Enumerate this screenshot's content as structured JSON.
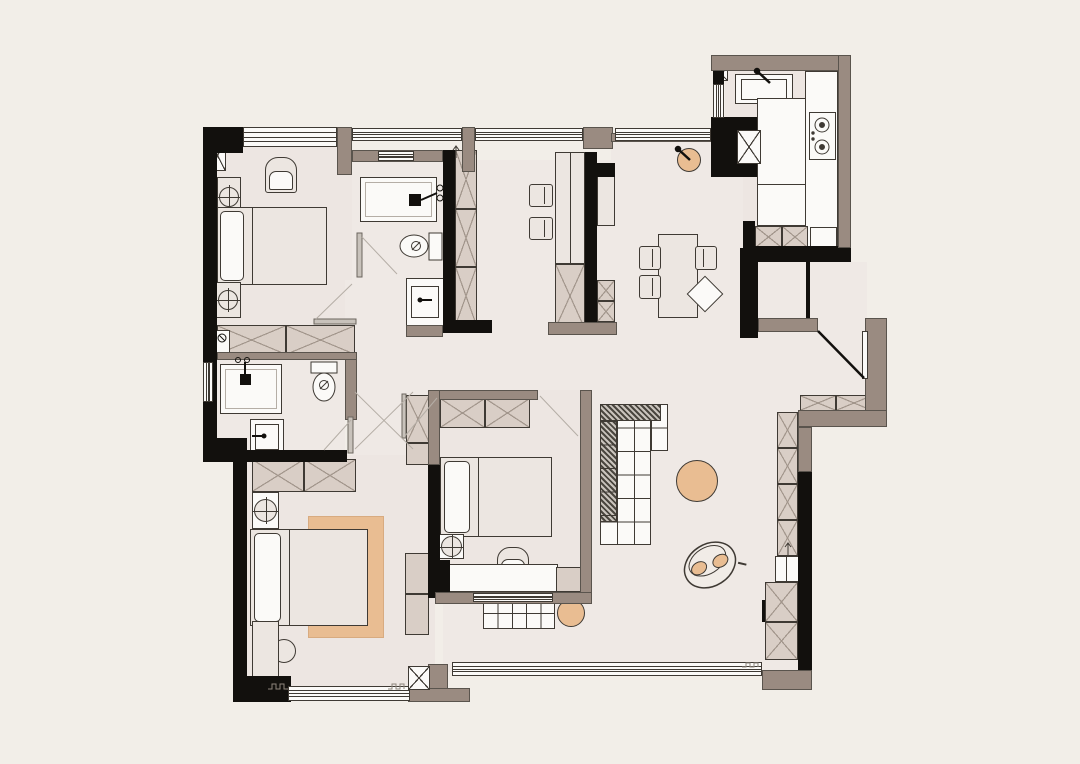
{
  "title": "apartment-floor-plan",
  "colors": {
    "bg": "#f2eee8",
    "floor": "#efe9e5",
    "floorwarm": "#ede6e2",
    "wall": "#12100d",
    "taupe": "#9a8b81",
    "cab": "#d9cec6",
    "light": "#ece6e1",
    "white": "#fbfaf8",
    "tan": "#e9bd92",
    "line": "#3f3a34",
    "swing": "#b5aea6",
    "xline": "#a2968c",
    "hatch": "#4a463f"
  },
  "rooms": [
    {
      "name": "master-bedroom",
      "furniture": [
        "double-bed",
        "pillow",
        "nightstand-with-lamp",
        "nightstand-with-lamp",
        "armchair",
        "wardrobe",
        "window"
      ]
    },
    {
      "name": "ensuite-bathroom",
      "furniture": [
        "shower",
        "toilet",
        "washbasin",
        "tall-cabinet"
      ]
    },
    {
      "name": "guest-bathroom",
      "furniture": [
        "shower",
        "toilet",
        "washbasin",
        "washer-valves"
      ]
    },
    {
      "name": "study-corridor",
      "furniture": [
        "desk-cabinet",
        "chair",
        "chair",
        "storage-cells"
      ]
    },
    {
      "name": "laundry-corridor",
      "furniture": [
        "round-basin",
        "window"
      ]
    },
    {
      "name": "kitchen",
      "furniture": [
        "sink-counter",
        "gas-stove",
        "l-counter",
        "fridge",
        "oven",
        "window"
      ]
    },
    {
      "name": "entry",
      "furniture": [
        "entry-door",
        "shoe-cabinet",
        "closet"
      ]
    },
    {
      "name": "dining-area",
      "furniture": [
        "dining-table",
        "chair",
        "chair",
        "chair",
        "diamond-chair"
      ]
    },
    {
      "name": "living-area",
      "furniture": [
        "l-shaped-modular-sofa",
        "round-coffee-table",
        "lounge-chair",
        "tv-cabinet-column",
        "storage-cabinets",
        "balcony-slider"
      ]
    },
    {
      "name": "bedroom-2",
      "furniture": [
        "double-bed",
        "wardrobe",
        "corner-cabinet",
        "lamp-side-table",
        "armchair",
        "desk",
        "bench-cushions",
        "round-side-table",
        "window"
      ]
    },
    {
      "name": "bedroom-3",
      "furniture": [
        "double-bed",
        "area-rug",
        "nightstand-with-lamp",
        "round-stool",
        "side-shelf",
        "wardrobe",
        "side-cabinet",
        "window"
      ]
    }
  ]
}
